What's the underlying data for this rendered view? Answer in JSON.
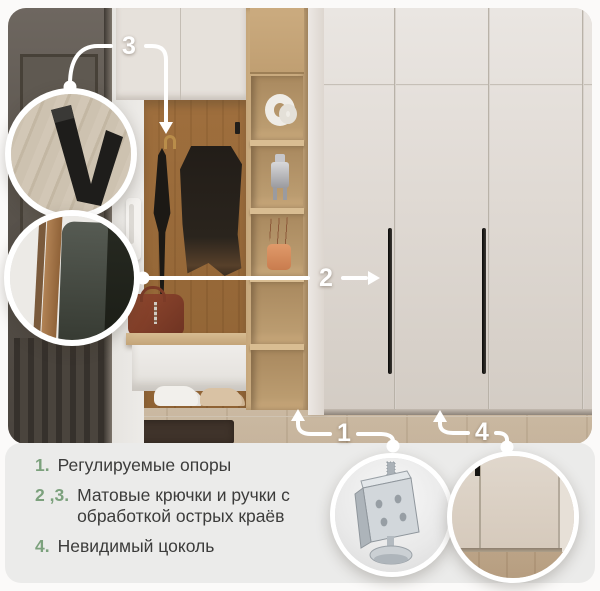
{
  "accent_green": "#7ca17d",
  "line_color": "#ffffff",
  "panel_color": "#ebebea",
  "callout_labels": {
    "one": "1",
    "two": "2",
    "three": "3",
    "four": "4"
  },
  "legend": {
    "items": [
      {
        "num": "1.",
        "text": "Регулируемые опоры"
      },
      {
        "num": "2 ,3.",
        "text": "Матовые крючки и ручки с обработкой острых краёв"
      },
      {
        "num": "4.",
        "text": "Невидимый цоколь"
      }
    ]
  },
  "insets": {
    "hook": "matte-black-wall-hook-closeup",
    "handle": "matte-handle-edge-closeup",
    "foot": "adjustable-metal-support-foot",
    "plinth": "invisible-plinth-bottom-of-wardrobe"
  }
}
